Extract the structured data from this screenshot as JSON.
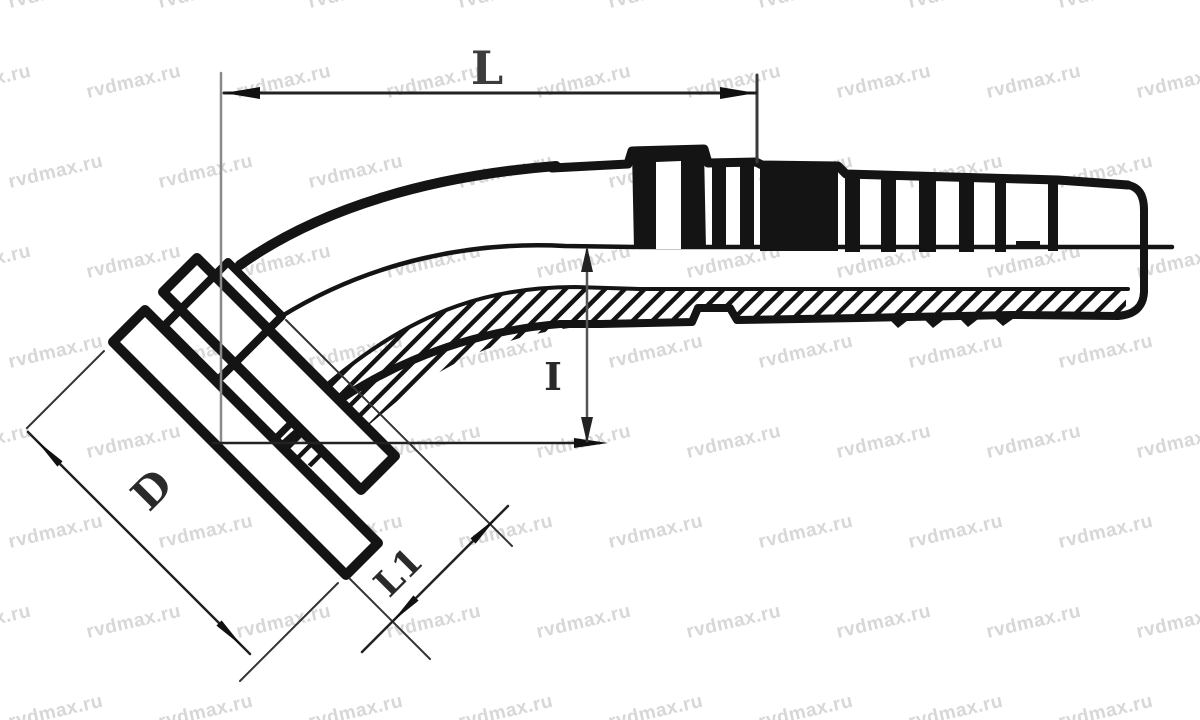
{
  "watermark": {
    "text": "rvdmax.ru",
    "color": "#d7d7d7"
  },
  "labels": {
    "overall_length": "L",
    "drop_height": "I",
    "flange_diameter": "D",
    "neck_length": "L1"
  },
  "colors": {
    "ink": "#141414",
    "dimension": "#2a2a2a",
    "extension": "#8a8a8a",
    "label": "#3c3c3c",
    "background": "#ffffff"
  }
}
